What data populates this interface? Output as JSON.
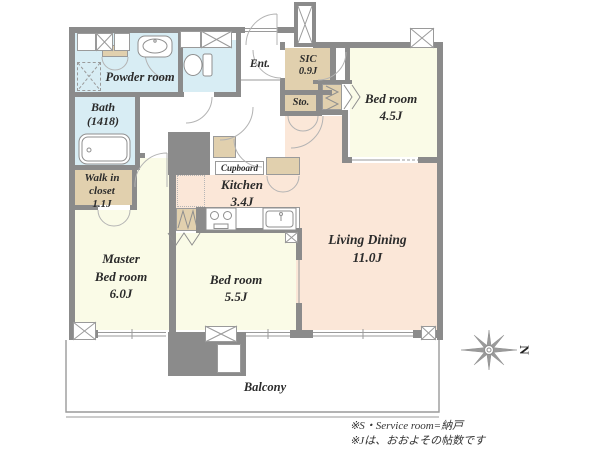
{
  "colors": {
    "wall": "#8b8b8b",
    "wet": "#d8edf4",
    "bed": "#fafbe7",
    "ldk": "#fbe7d8",
    "closet": "#e1d0ae",
    "line": "#9a9a9a",
    "text": "#2b2b2b"
  },
  "rooms": {
    "powder_room": {
      "label": "Powder room"
    },
    "bath": {
      "label": "Bath",
      "size": "(1418)"
    },
    "walk_in_closet": {
      "line1": "Walk in",
      "line2": "closet",
      "size": "1.1J"
    },
    "master_bedroom": {
      "line1": "Master",
      "line2": "Bed room",
      "size": "6.0J"
    },
    "entrance": {
      "label": "Ent."
    },
    "sic": {
      "label": "SIC",
      "size": "0.9J"
    },
    "storage": {
      "label": "Sto."
    },
    "bedroom_45": {
      "label": "Bed room",
      "size": "4.5J"
    },
    "kitchen": {
      "label": "Kitchen",
      "size": "3.4J"
    },
    "cupboard": {
      "label": "Cupboard"
    },
    "bedroom_55": {
      "label": "Bed room",
      "size": "5.5J"
    },
    "living_dining": {
      "label": "Living Dining",
      "size": "11.0J"
    },
    "balcony": {
      "label": "Balcony"
    }
  },
  "compass": {
    "label": "N"
  },
  "notes": {
    "line1": "※S・Service room=納戸",
    "line2": "※Jは、おおよその帖数です"
  }
}
